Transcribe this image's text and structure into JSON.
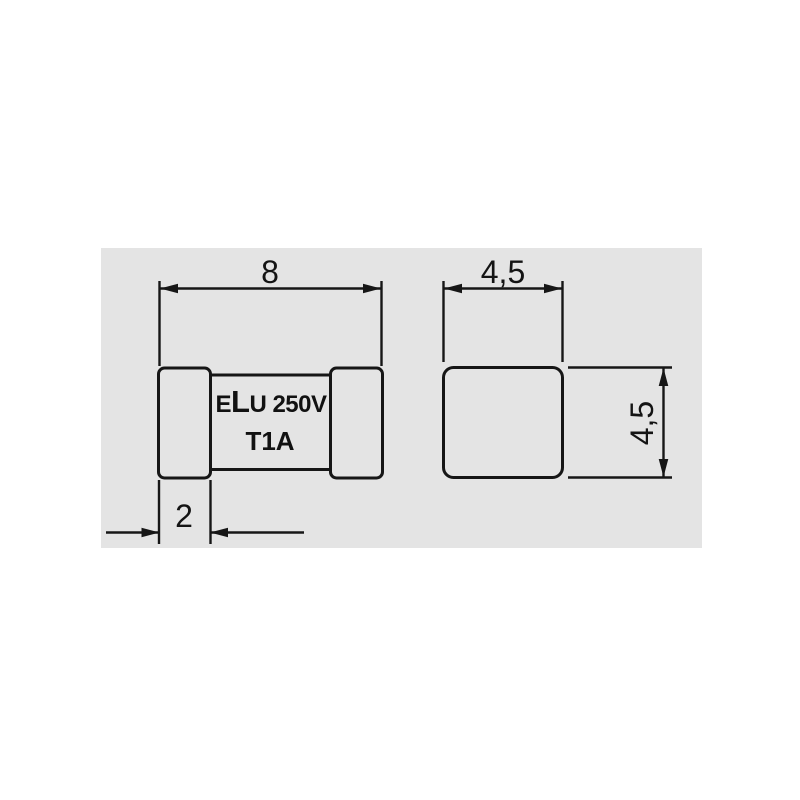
{
  "drawing": {
    "panel_color": "#e4e4e4",
    "line_color": "#161616",
    "component": {
      "marking_e": "E",
      "marking_l": "L",
      "marking_rest": "U 250V",
      "marking_line2": "T1A"
    },
    "dimensions": {
      "total_length": "8",
      "cap_length": "2",
      "end_width": "4,5",
      "end_height": "4,5"
    }
  }
}
